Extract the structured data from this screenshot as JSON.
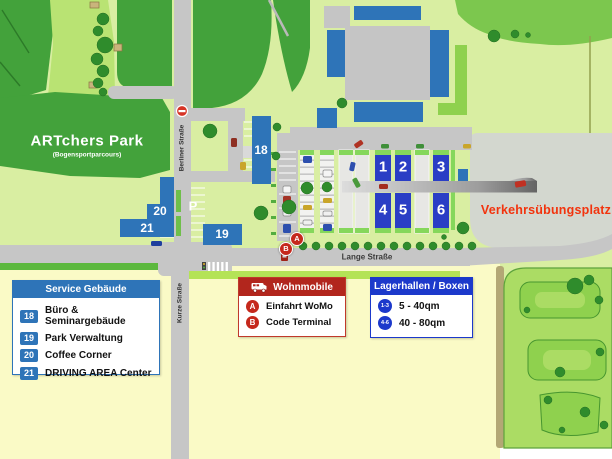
{
  "park": {
    "title": "ARTchers Park",
    "subtitle": "(Bogensportparcours)"
  },
  "streets": {
    "berliner": "Berliner Straße",
    "kurze": "Kurze Straße",
    "lange": "Lange Straße"
  },
  "areas": {
    "practice_ground": "Verkehrsübungsplatz"
  },
  "buildings": {
    "b18": "18",
    "b19": "19",
    "b20": "20",
    "b21": "21"
  },
  "halls": {
    "h1": "1",
    "h2": "2",
    "h3": "3",
    "h4": "4",
    "h5": "5",
    "h6": "6"
  },
  "markers": {
    "parking": "P",
    "womo_entrance": "A",
    "code_terminal": "B"
  },
  "legends": {
    "service": {
      "title": "Service Gebäude",
      "items": [
        {
          "num": "18",
          "label": "Büro & Seminargebäude"
        },
        {
          "num": "19",
          "label": "Park Verwaltung"
        },
        {
          "num": "20",
          "label": "Coffee Corner"
        },
        {
          "num": "21",
          "label": "DRIVING AREA Center"
        }
      ]
    },
    "wohnmobile": {
      "title": "Wohnmobile",
      "items": [
        {
          "key": "A",
          "label": "Einfahrt WoMo"
        },
        {
          "key": "B",
          "label": "Code Terminal"
        }
      ]
    },
    "lagerhallen": {
      "title": "Lagerhallen / Boxen",
      "items": [
        {
          "key": "1-3",
          "label": "5 - 40qm"
        },
        {
          "key": "4-6",
          "label": "40 - 80qm"
        }
      ]
    }
  },
  "colors": {
    "building_blue": "#2e74b8",
    "hall_blue": "#2a3ec5",
    "storage_header_blue": "#1c39cb",
    "wohnmobile_header_red": "#b2261d",
    "marker_red": "#c5281c",
    "practice_label_red": "#f2330d",
    "forest_green": "#43a23b",
    "road_gray": "#c6c6c6",
    "area_yellow": "#fafac6"
  }
}
